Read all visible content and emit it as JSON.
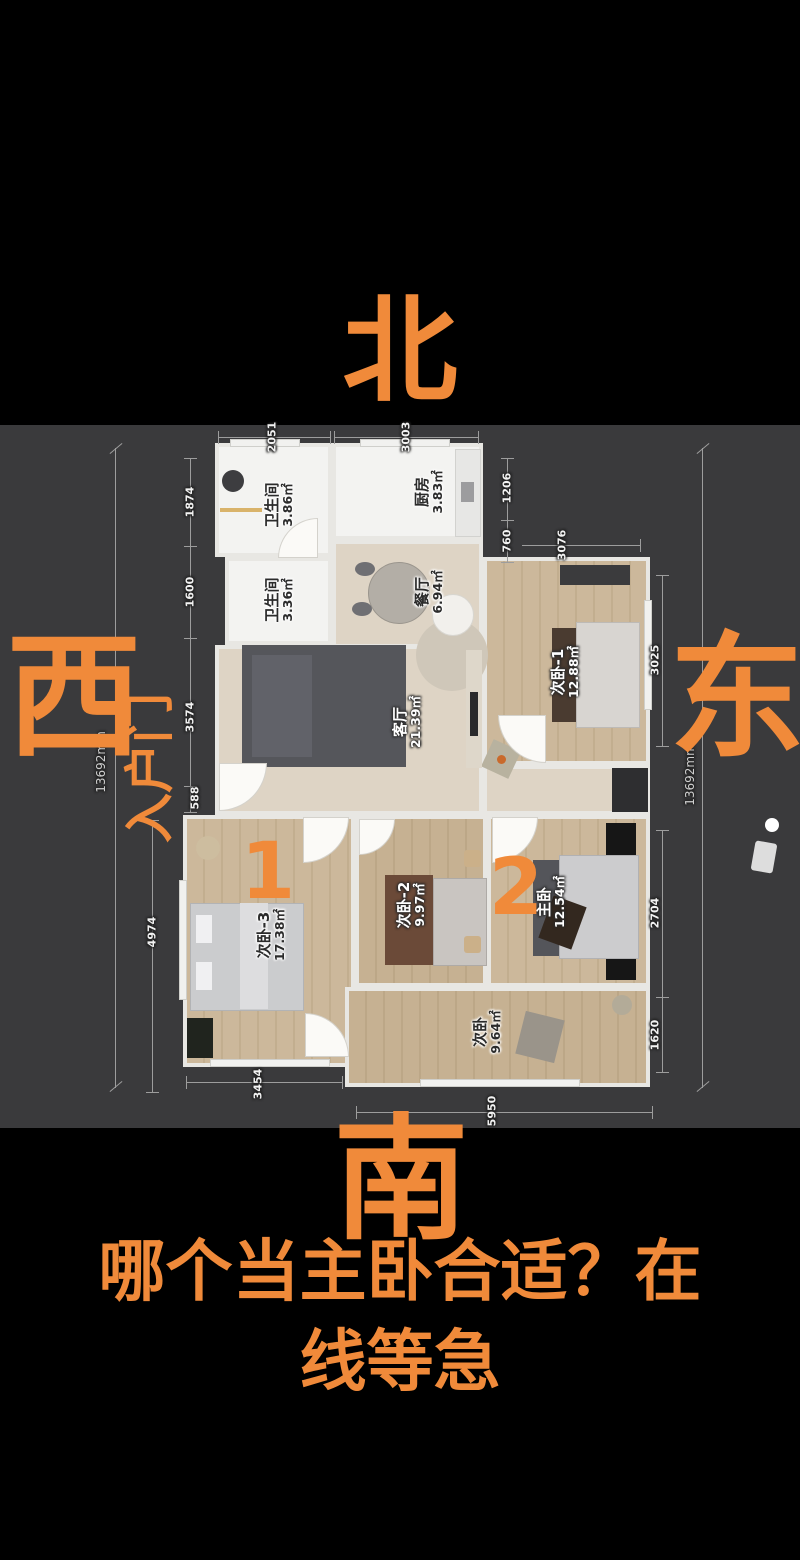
{
  "overlay": {
    "north": "北",
    "west": "西",
    "east": "东",
    "south": "南",
    "entrance_label": "入户门",
    "mark1": "1",
    "mark2": "2",
    "caption_line1": "哪个当主卧合适？在",
    "caption_line2": "线等急",
    "accent_color": "#f08a3a"
  },
  "floorplan": {
    "rooms": [
      {
        "name": "卫生间",
        "area": "3.86㎡"
      },
      {
        "name": "厨房",
        "area": "3.83㎡"
      },
      {
        "name": "卫生间",
        "area": "3.36㎡"
      },
      {
        "name": "餐厅",
        "area": "6.94㎡"
      },
      {
        "name": "客厅",
        "area": "21.39㎡"
      },
      {
        "name": "次卧-1",
        "area": "12.88㎡"
      },
      {
        "name": "次卧-3",
        "area": "17.38㎡"
      },
      {
        "name": "次卧-2",
        "area": "9.97㎡"
      },
      {
        "name": "主卧",
        "area": "12.54㎡"
      },
      {
        "name": "次卧",
        "area": "9.64㎡"
      }
    ],
    "dims": {
      "top": [
        "2051",
        "3003"
      ],
      "left_outer": "13692mm",
      "left_inner": [
        "1874",
        "1600",
        "3574",
        "588",
        "4974"
      ],
      "bottom": [
        "3454",
        "5950"
      ],
      "right_small": [
        "1206",
        "760",
        "3076"
      ],
      "right_inner": [
        "3025",
        "2704",
        "1620"
      ],
      "right_outer": "13692mm"
    }
  }
}
